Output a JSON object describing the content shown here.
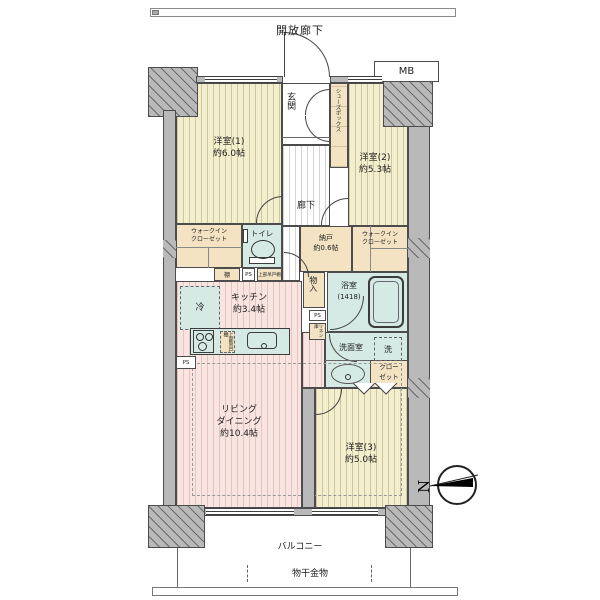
{
  "colors": {
    "wall": "#b9b9b9",
    "cream": "#f3eecd",
    "pink": "#f8e4e1",
    "teal": "#d5eae4",
    "beige": "#f4e3c2"
  },
  "top": {
    "open_corridor": "開放廊下",
    "mb": "MB"
  },
  "rooms": {
    "entrance": {
      "label": "玄関"
    },
    "shoebox": {
      "label": "シューズボックス"
    },
    "bedroom1": {
      "name": "洋室(1)",
      "size": "約6.0帖"
    },
    "bedroom2": {
      "name": "洋室(2)",
      "size": "約5.3帖"
    },
    "hallway": {
      "label": "廊下"
    },
    "wic_left": {
      "line1": "ウォークイン",
      "line2": "クローゼット"
    },
    "toilet": {
      "label": "トイレ"
    },
    "nando": {
      "name": "納戸",
      "size": "約0.6帖"
    },
    "wic_right": {
      "line1": "ウォークイン",
      "line2": "クローゼット"
    },
    "shelf": {
      "label": "棚"
    },
    "ps_top": {
      "label": "PS"
    },
    "upper_cabinet": {
      "label": "上部吊戸棚"
    },
    "fridge": {
      "label": "冷"
    },
    "kitchen": {
      "name": "キッチン",
      "size": "約3.4帖"
    },
    "monoire": {
      "label": "物入"
    },
    "bath": {
      "name": "浴室",
      "size": "(1418)"
    },
    "ps_mid": {
      "label": "PS"
    },
    "linen": {
      "label": "リネン庫"
    },
    "washroom": {
      "label": "洗面室",
      "washer": "洗"
    },
    "closet": {
      "line1": "クロー",
      "line2": "ゼット"
    },
    "counter_cabinet": {
      "label": "上部吊戸棚"
    },
    "ps_bottom": {
      "label": "PS"
    },
    "living": {
      "line1": "リビング",
      "line2": "ダイニング",
      "size": "約10.4帖"
    },
    "bedroom3": {
      "name": "洋室(3)",
      "size": "約5.0帖"
    }
  },
  "bottom": {
    "balcony": "バルコニー",
    "laundry": "物干金物"
  },
  "compass": {
    "north": "N"
  }
}
